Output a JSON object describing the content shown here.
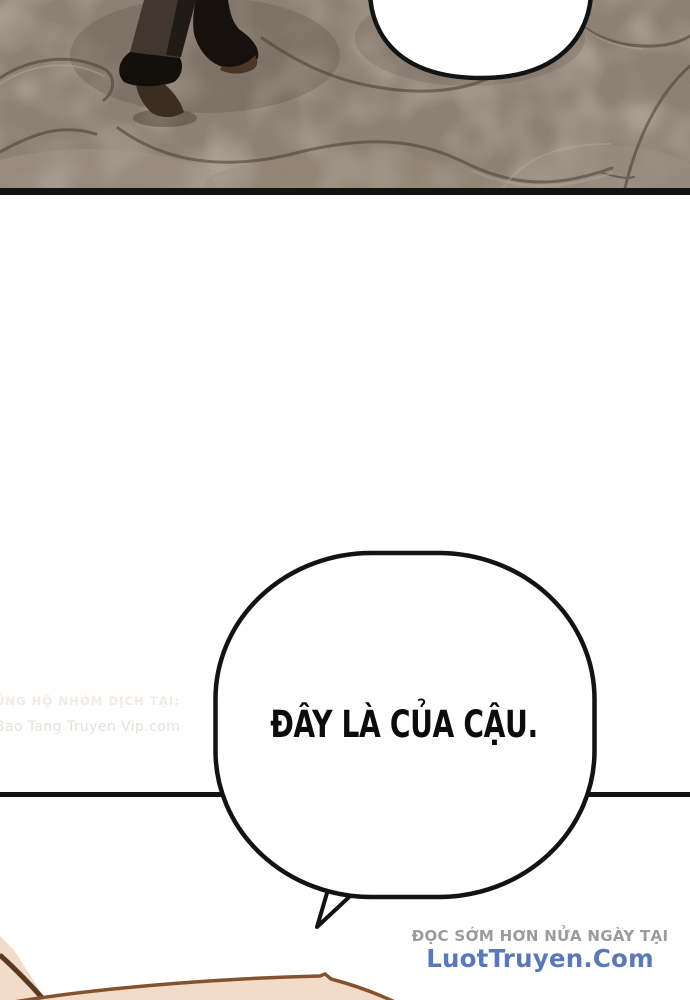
{
  "speech": {
    "main_bubble_text": "ĐÂY LÀ CỦA CẬU.",
    "top_bubble_text": ""
  },
  "watermarks": {
    "left": {
      "line1": "ỦNG HỘ NHÓM DỊCH TẠI:",
      "line2": "Bao Tang Truyen Vip.com"
    },
    "bottom_right": {
      "line1": "ĐỌC SỚM HƠN NỬA NGÀY TẠI",
      "line2": "LuotTruyen.Com"
    }
  },
  "colors": {
    "ink": "#131313",
    "watermark_gray": "#9b9b9b",
    "watermark_blue": "#5b79b8",
    "left_wm_1": "#f1e9e4",
    "left_wm_2": "#e7e1dc",
    "stone_base": "#8c7f73",
    "skin": "#f3dbc9",
    "skin_outline": "#85522e"
  }
}
